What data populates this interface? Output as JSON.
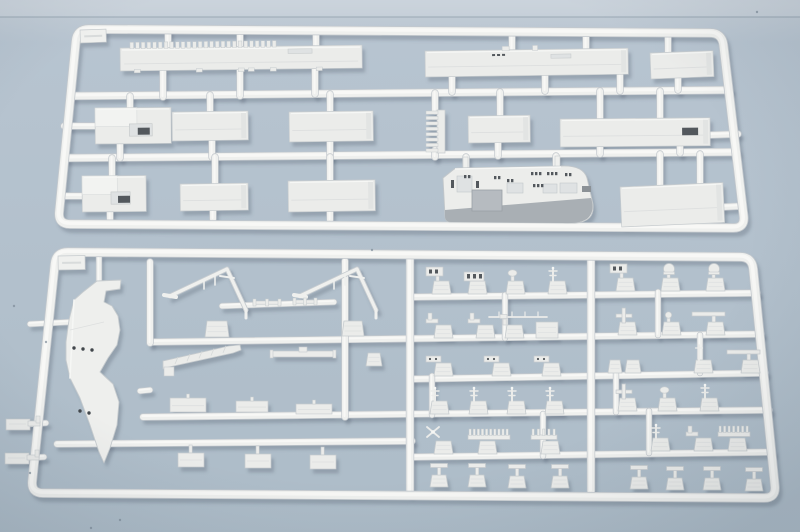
{
  "photo": {
    "subject": "Two light-grey injection-molded polystyrene model-kit sprues (aircraft carrier parts) photographed on a blue-grey surface",
    "sprue_count": 2,
    "plastic_color_name": "light grey",
    "no_visible_text": true
  },
  "palette": {
    "bg_top": "#c6cfd8",
    "bg_main": "#b7c4d0",
    "bg_bottom": "#adbcc8",
    "seam": "#98a6b2",
    "plastic_edge": "#c3c8cd",
    "plastic": "#eff0ee",
    "plastic_hi": "#f8f8f6",
    "part_fill": "#ebecea",
    "part_stroke": "#c6cbce",
    "part_hi": "#f6f7f5",
    "recess": "#dfe2e3",
    "deep_recess": "#b6bbc0",
    "island_band": "#a9afb4",
    "dark_detail": "#53585d",
    "hole": "#41464b",
    "shadow": "rgba(75,90,105,0.30)",
    "dust": "#7e8c98"
  },
  "part_names": {
    "deck": "part-flight-deck-edge-section",
    "panel": "part-hull-panel",
    "box": "part-hull-block",
    "ladder": "part-ladder-strip",
    "island": "part-island-superstructure",
    "blade": "part-bow-hull-blade",
    "vmast": "part-yardarm-mast",
    "boom": "part-crane-boom",
    "bar": "part-antenna-bar",
    "shaft": "part-shaft",
    "tab": "part-molding-tab",
    "panelS": "part-small-panel",
    "teeH": "part-tee-fitting",
    "bracket": "part-bracket",
    "tag": "sprue-id-tag",
    "fit": {
      "dome": "part-radar-dome",
      "panel2": "part-radar-panel",
      "win3": "part-window-block",
      "disc": "part-director-disc",
      "ant": "part-antenna-mast",
      "bracketF": "part-bracket-fitting",
      "whipH": "part-whip-antenna",
      "tabBig": "part-molding-tab",
      "cross": "part-cross-fitting",
      "knob": "part-knob-fitting",
      "teeTop": "part-tee-fitting",
      "hinge": "part-hinge-fitting",
      "tab2": "part-twin-tabs",
      "whipV": "part-whip-antenna",
      "prop": "part-propeller-fitting",
      "comb10": "part-railing-comb",
      "comb7": "part-railing-comb",
      "comb5": "part-railing-comb",
      "teeStand": "part-stand-fitting"
    }
  },
  "scene": {
    "width": 800,
    "height": 532,
    "seam_y": 17,
    "dust": [
      [
        46,
        342
      ],
      [
        30,
        473
      ],
      [
        14,
        306
      ],
      [
        91,
        528
      ],
      [
        757,
        12
      ],
      [
        372,
        250
      ],
      [
        120,
        520
      ]
    ]
  },
  "sprues": [
    {
      "id": "sprue-top",
      "frame": [
        [
          77,
          29
        ],
        [
          722,
          33
        ],
        [
          745,
          228
        ],
        [
          58,
          224
        ]
      ],
      "frame_w": 8,
      "runners": [
        [
          70,
          96,
          729,
          90,
          7
        ],
        [
          64,
          158,
          736,
          152,
          7
        ],
        [
          168,
          31,
          168,
          52,
          6
        ],
        [
          240,
          31,
          240,
          48,
          6
        ],
        [
          316,
          32,
          316,
          46,
          6
        ],
        [
          512,
          33,
          512,
          52,
          6
        ],
        [
          586,
          33,
          586,
          52,
          6
        ],
        [
          668,
          34,
          668,
          53,
          6
        ],
        [
          163,
          70,
          163,
          97,
          6
        ],
        [
          240,
          69,
          240,
          96,
          6
        ],
        [
          315,
          67,
          315,
          94,
          6
        ],
        [
          452,
          76,
          452,
          92,
          6
        ],
        [
          545,
          75,
          545,
          91,
          6
        ],
        [
          620,
          75,
          620,
          91,
          6
        ],
        [
          678,
          78,
          678,
          90,
          6
        ],
        [
          130,
          96,
          130,
          112,
          6
        ],
        [
          210,
          95,
          210,
          114,
          6
        ],
        [
          330,
          94,
          330,
          113,
          6
        ],
        [
          435,
          93,
          435,
          111,
          6
        ],
        [
          500,
          92,
          500,
          118,
          6
        ],
        [
          600,
          91,
          600,
          121,
          6
        ],
        [
          660,
          91,
          660,
          121,
          6
        ],
        [
          120,
          142,
          120,
          158,
          6
        ],
        [
          212,
          140,
          212,
          157,
          6
        ],
        [
          330,
          141,
          330,
          156,
          6
        ],
        [
          435,
          150,
          435,
          157,
          6
        ],
        [
          498,
          141,
          498,
          156,
          6
        ],
        [
          600,
          145,
          600,
          154,
          6
        ],
        [
          680,
          146,
          680,
          153,
          6
        ],
        [
          112,
          158,
          112,
          178,
          6
        ],
        [
          215,
          157,
          215,
          185,
          6
        ],
        [
          330,
          157,
          330,
          182,
          6
        ],
        [
          466,
          157,
          466,
          170,
          6
        ],
        [
          556,
          156,
          556,
          168,
          6
        ],
        [
          660,
          154,
          660,
          188,
          6
        ],
        [
          700,
          154,
          700,
          188,
          6
        ],
        [
          110,
          210,
          110,
          220,
          6
        ],
        [
          213,
          210,
          213,
          219,
          6
        ],
        [
          330,
          211,
          330,
          220,
          6
        ],
        [
          64,
          126,
          96,
          126,
          6
        ],
        [
          66,
          196,
          84,
          196,
          6
        ],
        [
          710,
          135,
          738,
          134,
          6
        ],
        [
          723,
          207,
          742,
          206,
          6
        ]
      ],
      "parts": [
        {
          "t": "tag",
          "x": 80,
          "y": 30,
          "w": 26,
          "h": 13,
          "r": -2
        },
        {
          "t": "deck",
          "x": 120,
          "y": 48,
          "w": 242,
          "h": 23,
          "r": -0.7
        },
        {
          "t": "panel",
          "x": 425,
          "y": 51,
          "w": 203,
          "h": 26,
          "r": -0.8,
          "d": "deck"
        },
        {
          "t": "panel",
          "x": 650,
          "y": 53,
          "w": 63,
          "h": 26,
          "r": -2.2
        },
        {
          "t": "box",
          "x": 95,
          "y": 108,
          "w": 76,
          "h": 36,
          "r": -0.5
        },
        {
          "t": "panel",
          "x": 172,
          "y": 112,
          "w": 76,
          "h": 29,
          "r": -0.8
        },
        {
          "t": "panel",
          "x": 289,
          "y": 112,
          "w": 84,
          "h": 30,
          "r": -0.8
        },
        {
          "t": "ladder",
          "x": 426,
          "y": 110,
          "w": 19,
          "h": 43
        },
        {
          "t": "panel",
          "x": 468,
          "y": 116,
          "w": 62,
          "h": 27,
          "r": -0.8
        },
        {
          "t": "panel",
          "x": 560,
          "y": 119,
          "w": 150,
          "h": 28,
          "r": -0.5,
          "slot": true
        },
        {
          "t": "box",
          "x": 82,
          "y": 176,
          "w": 64,
          "h": 36,
          "r": -0.5
        },
        {
          "t": "panel",
          "x": 180,
          "y": 184,
          "w": 68,
          "h": 27,
          "r": -0.8
        },
        {
          "t": "panel",
          "x": 288,
          "y": 181,
          "w": 87,
          "h": 31,
          "r": -0.8
        },
        {
          "t": "island",
          "x": 443,
          "y": 160,
          "w": 153,
          "h": 65
        },
        {
          "t": "panel",
          "x": 620,
          "y": 187,
          "w": 103,
          "h": 40,
          "r": -2.5
        }
      ]
    },
    {
      "id": "sprue-bottom",
      "frame": [
        [
          56,
          252
        ],
        [
          752,
          257
        ],
        [
          776,
          498
        ],
        [
          31,
          493
        ]
      ],
      "frame_w": 8,
      "runners": [
        [
          412,
          297,
          757,
          293,
          6
        ],
        [
          152,
          342,
          761,
          334,
          6
        ],
        [
          412,
          379,
          765,
          373,
          6
        ],
        [
          143,
          417,
          769,
          410,
          6
        ],
        [
          57,
          444,
          412,
          441,
          6
        ],
        [
          412,
          457,
          772,
          452,
          6
        ],
        [
          222,
          306,
          334,
          302,
          5
        ],
        [
          150,
          262,
          150,
          343,
          6
        ],
        [
          345,
          261,
          345,
          417,
          6
        ],
        [
          410,
          259,
          410,
          492,
          7
        ],
        [
          591,
          259,
          591,
          491,
          7
        ],
        [
          505,
          295,
          505,
          338,
          5
        ],
        [
          658,
          292,
          658,
          335,
          5
        ],
        [
          432,
          376,
          432,
          415,
          5
        ],
        [
          616,
          373,
          616,
          412,
          5
        ],
        [
          543,
          414,
          543,
          456,
          5
        ],
        [
          649,
          411,
          649,
          453,
          5
        ],
        [
          700,
          335,
          700,
          373,
          5
        ],
        [
          99,
          256,
          99,
          284,
          5
        ],
        [
          30,
          324,
          70,
          322,
          5
        ],
        [
          140,
          391,
          150,
          390,
          5
        ],
        [
          28,
          424,
          46,
          423,
          5
        ],
        [
          26,
          458,
          44,
          457,
          5
        ]
      ],
      "parts": [
        {
          "t": "tag",
          "x": 58,
          "y": 256,
          "w": 27,
          "h": 14,
          "r": -1
        },
        {
          "t": "blade",
          "pts": [
            [
              97,
              281
            ],
            [
              121,
              280
            ],
            [
              120,
              289
            ],
            [
              106,
              291
            ],
            [
              104,
              302
            ],
            [
              112,
              306
            ],
            [
              118,
              316
            ],
            [
              120,
              330
            ],
            [
              117,
              345
            ],
            [
              108,
              358
            ],
            [
              100,
              372
            ],
            [
              113,
              384
            ],
            [
              119,
              402
            ],
            [
              117,
              425
            ],
            [
              110,
              448
            ],
            [
              104,
              463
            ],
            [
              99,
              452
            ],
            [
              90,
              425
            ],
            [
              80,
              398
            ],
            [
              70,
              378
            ],
            [
              66,
              360
            ],
            [
              66,
              342
            ],
            [
              69,
              320
            ],
            [
              74,
              300
            ],
            [
              83,
              292
            ]
          ],
          "holes": [
            [
              74,
              348
            ],
            [
              83,
              349
            ],
            [
              92,
              350
            ],
            [
              80,
              411
            ],
            [
              89,
              413
            ]
          ]
        },
        {
          "t": "bracket",
          "x": 6,
          "y": 416
        },
        {
          "t": "bracket",
          "x": 5,
          "y": 450
        },
        {
          "t": "vmast",
          "x": 170,
          "y": 266
        },
        {
          "t": "vmast",
          "x": 300,
          "y": 266
        },
        {
          "t": "shaft",
          "x": 253,
          "y": 301,
          "w": 28
        },
        {
          "t": "shaft",
          "x": 293,
          "y": 300,
          "w": 24
        },
        {
          "t": "tab",
          "x": 205,
          "y": 321,
          "w": 24,
          "h": 16
        },
        {
          "t": "tab",
          "x": 342,
          "y": 321,
          "w": 22,
          "h": 15
        },
        {
          "t": "boom",
          "x": 163,
          "y": 345
        },
        {
          "t": "bar",
          "x": 272,
          "y": 351,
          "w": 62
        },
        {
          "t": "tab",
          "x": 366,
          "y": 353,
          "w": 16,
          "h": 13
        },
        {
          "t": "panelS",
          "x": 170,
          "y": 398,
          "w": 36,
          "h": 14
        },
        {
          "t": "panelS",
          "x": 236,
          "y": 401,
          "w": 32,
          "h": 11
        },
        {
          "t": "panelS",
          "x": 296,
          "y": 404,
          "w": 36,
          "h": 10
        },
        {
          "t": "teeH",
          "x": 178,
          "b": 445
        },
        {
          "t": "teeH",
          "x": 245,
          "b": 446
        },
        {
          "t": "teeH",
          "x": 310,
          "b": 447
        },
        {
          "t": "fit",
          "k": "panel2",
          "x": 424,
          "b": 294
        },
        {
          "t": "fit",
          "k": "win3",
          "x": 460,
          "b": 294
        },
        {
          "t": "fit",
          "k": "disc",
          "x": 498,
          "b": 294
        },
        {
          "t": "fit",
          "k": "ant",
          "x": 540,
          "b": 294
        },
        {
          "t": "fit",
          "k": "panel2",
          "x": 608,
          "b": 291
        },
        {
          "t": "fit",
          "k": "dome",
          "x": 653,
          "b": 291
        },
        {
          "t": "fit",
          "k": "dome",
          "x": 698,
          "b": 291
        },
        {
          "t": "fit",
          "k": "bracketF",
          "x": 426,
          "b": 338
        },
        {
          "t": "fit",
          "k": "bracketF",
          "x": 468,
          "b": 338
        },
        {
          "t": "fit",
          "k": "whipH",
          "x": 497,
          "b": 338
        },
        {
          "t": "fit",
          "k": "tabBig",
          "x": 536,
          "b": 338
        },
        {
          "t": "fit",
          "k": "cross",
          "x": 610,
          "b": 335
        },
        {
          "t": "fit",
          "k": "knob",
          "x": 654,
          "b": 335
        },
        {
          "t": "fit",
          "k": "teeTop",
          "x": 698,
          "b": 335
        },
        {
          "t": "fit",
          "k": "hinge",
          "x": 426,
          "b": 376
        },
        {
          "t": "fit",
          "k": "hinge",
          "x": 484,
          "b": 376
        },
        {
          "t": "fit",
          "k": "hinge",
          "x": 534,
          "b": 376
        },
        {
          "t": "fit",
          "k": "tab2",
          "x": 608,
          "b": 373
        },
        {
          "t": "fit",
          "k": "whipV",
          "x": 686,
          "b": 373
        },
        {
          "t": "fit",
          "k": "teeTop",
          "x": 733,
          "b": 373
        },
        {
          "t": "fit",
          "k": "ant",
          "x": 422,
          "b": 414
        },
        {
          "t": "fit",
          "k": "ant",
          "x": 461,
          "b": 414
        },
        {
          "t": "fit",
          "k": "ant",
          "x": 499,
          "b": 414
        },
        {
          "t": "fit",
          "k": "ant",
          "x": 537,
          "b": 414
        },
        {
          "t": "fit",
          "k": "cross",
          "x": 610,
          "b": 411
        },
        {
          "t": "fit",
          "k": "disc",
          "x": 650,
          "b": 411
        },
        {
          "t": "fit",
          "k": "ant",
          "x": 692,
          "b": 411
        },
        {
          "t": "fit",
          "k": "prop",
          "x": 426,
          "b": 454
        },
        {
          "t": "fit",
          "k": "comb10",
          "x": 470,
          "b": 454
        },
        {
          "t": "fit",
          "k": "comb5",
          "x": 533,
          "b": 454
        },
        {
          "t": "fit",
          "k": "ant",
          "x": 643,
          "b": 451
        },
        {
          "t": "fit",
          "k": "bracketF",
          "x": 686,
          "b": 451
        },
        {
          "t": "fit",
          "k": "comb7",
          "x": 720,
          "b": 451
        },
        {
          "t": "fit",
          "k": "teeStand",
          "x": 430,
          "b": 487
        },
        {
          "t": "fit",
          "k": "teeStand",
          "x": 468,
          "b": 487
        },
        {
          "t": "fit",
          "k": "teeStand",
          "x": 508,
          "b": 488
        },
        {
          "t": "fit",
          "k": "teeStand",
          "x": 551,
          "b": 488
        },
        {
          "t": "fit",
          "k": "teeStand",
          "x": 630,
          "b": 489
        },
        {
          "t": "fit",
          "k": "teeStand",
          "x": 666,
          "b": 490
        },
        {
          "t": "fit",
          "k": "teeStand",
          "x": 703,
          "b": 490
        },
        {
          "t": "fit",
          "k": "teeStand",
          "x": 745,
          "b": 491
        }
      ]
    }
  ]
}
